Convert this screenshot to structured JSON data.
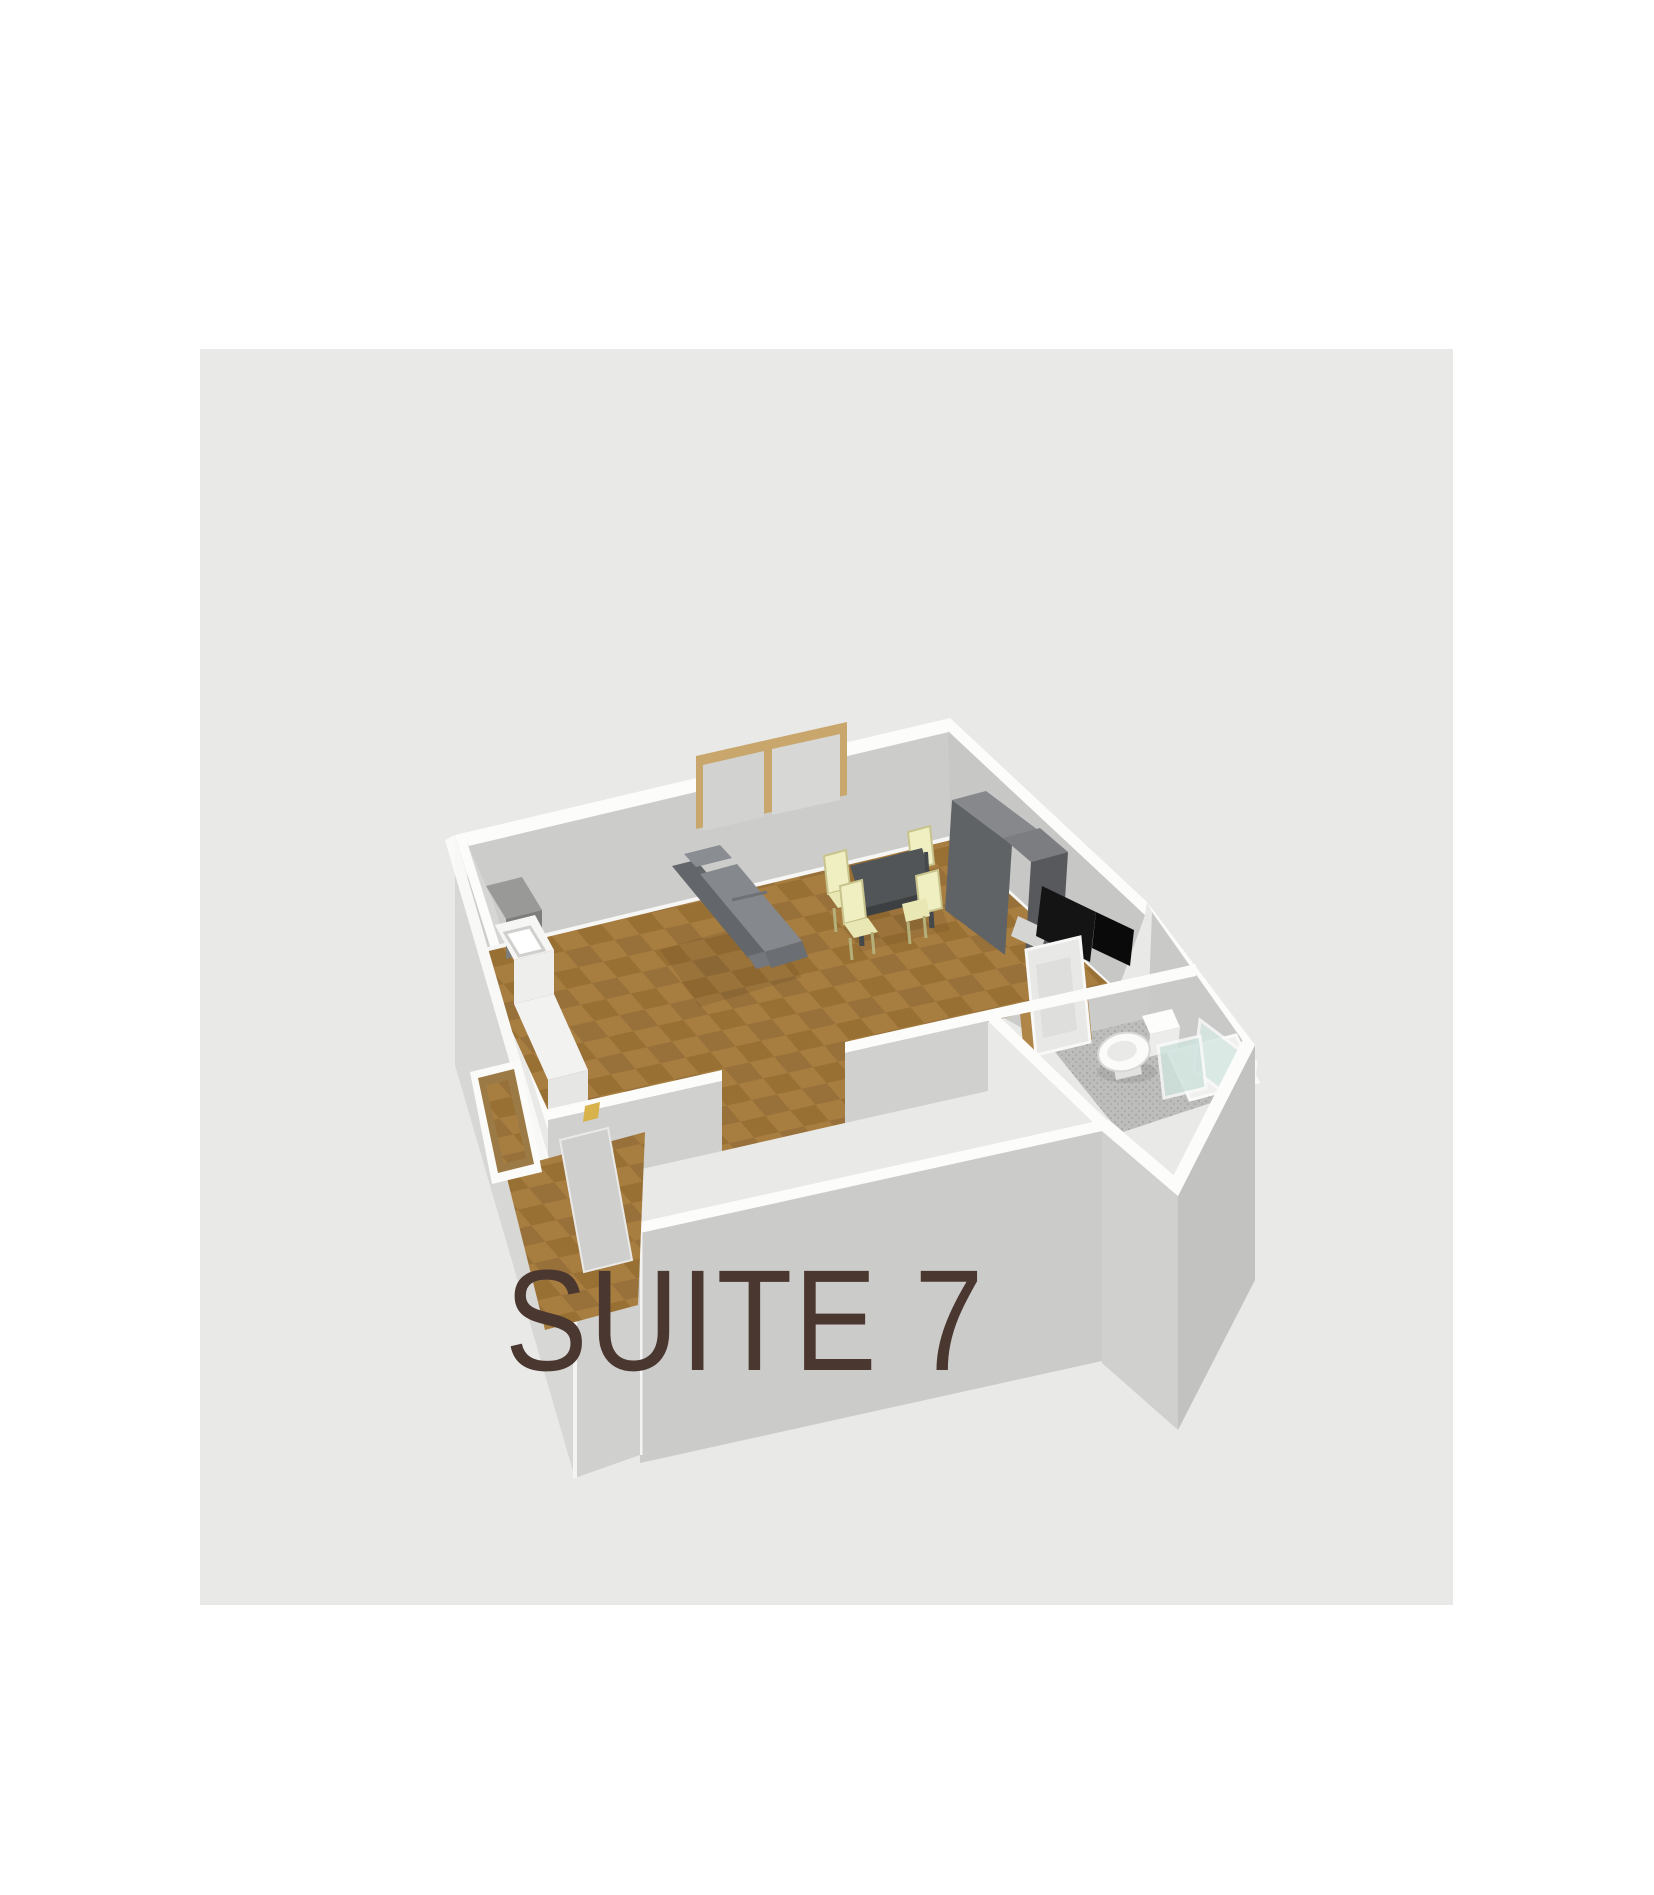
{
  "page": {
    "background_color": "#ffffff",
    "canvas_background_color": "#e9e9e8"
  },
  "floorplan": {
    "label": "SUITE 7",
    "label_color": "#4a372f",
    "view": "3d-isometric-dollhouse",
    "rooms": [
      {
        "name": "living-room-kitchen",
        "floor": "wood-parquet",
        "contents": [
          "window",
          "sofa",
          "dining-table",
          "four-dining-chairs",
          "tall-cabinet",
          "tv",
          "kitchen-counter-with-sink",
          "cooker"
        ]
      },
      {
        "name": "bathroom",
        "floor": "grey-tile",
        "contents": [
          "door",
          "toilet",
          "shower-enclosure"
        ]
      },
      {
        "name": "entrance-hall",
        "floor": "wood-parquet",
        "contents": [
          "entrance-door-open",
          "open-passage-to-living-room"
        ]
      }
    ],
    "colors": {
      "wall_face": "#cfcfcd",
      "wall_top": "#fcfcfb",
      "wood_floor_light": "#a87d40",
      "wood_floor_dark": "#997033",
      "bathroom_floor": "#bdbdbb",
      "sofa": "#6f7275",
      "dining_table": "#53575a",
      "chair": "#efeec0",
      "cabinet": "#64666a",
      "tv": "#141415",
      "window_frame": "#c9a76c",
      "shower_glass": "#d8e8e3"
    }
  }
}
